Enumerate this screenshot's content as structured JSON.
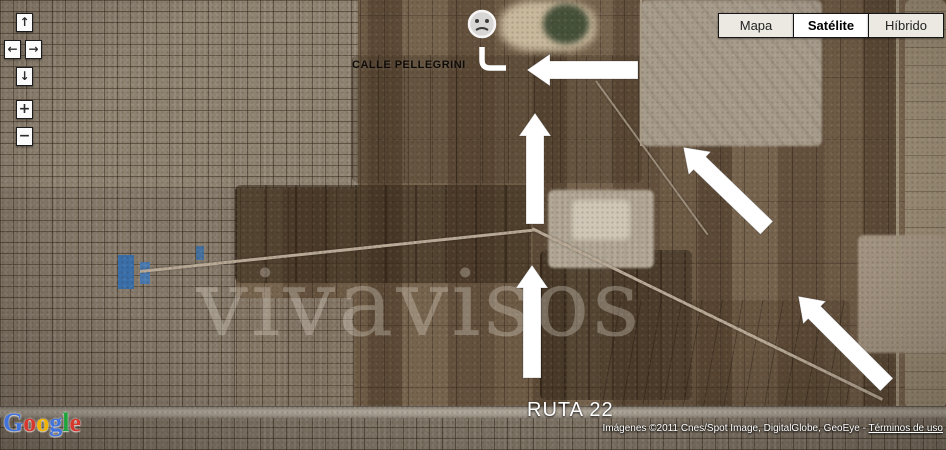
{
  "pan_zoom_control": {
    "pan_up": "↑",
    "pan_left": "←",
    "pan_right": "→",
    "pan_down": "↓",
    "zoom_in": "+",
    "zoom_out": "−"
  },
  "map_type_control": {
    "buttons": [
      {
        "label": "Mapa",
        "active": false
      },
      {
        "label": "Satélite",
        "active": true
      },
      {
        "label": "Híbrido",
        "active": false
      }
    ]
  },
  "map_labels": {
    "street": "CALLE PELLEGRINI",
    "route": "RUTA 22"
  },
  "watermark": {
    "text": "vivavisos"
  },
  "attribution": {
    "prefix": "Imágenes ©2011 Cnes/Spot Image, DigitalGlobe, GeoEye - ",
    "link_label": "Términos de uso"
  },
  "google_logo": {
    "letters": [
      {
        "ch": "G",
        "color": "#4273db"
      },
      {
        "ch": "o",
        "color": "#d7382d"
      },
      {
        "ch": "o",
        "color": "#f0b400"
      },
      {
        "ch": "g",
        "color": "#4273db"
      },
      {
        "ch": "l",
        "color": "#1ea43c"
      },
      {
        "ch": "e",
        "color": "#d7382d"
      }
    ]
  },
  "annotations": {
    "marker_icon": "frowning-face-icon",
    "route_elbow_icon": "elbow-line-icon",
    "direction_arrows": [
      "left",
      "up",
      "up",
      "up-left",
      "up-left"
    ],
    "arrow_color": "#ffffff"
  }
}
